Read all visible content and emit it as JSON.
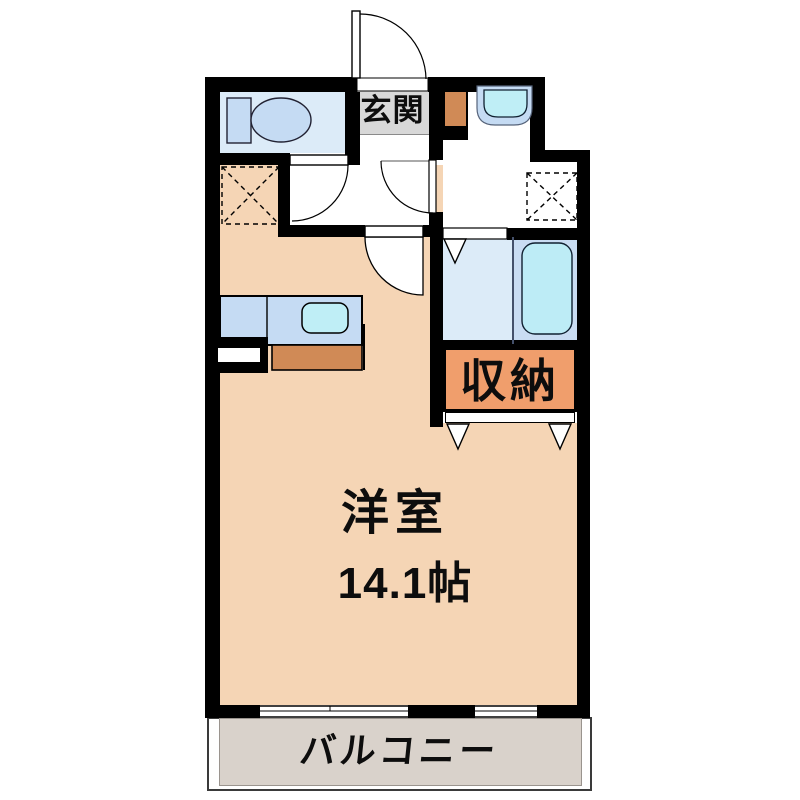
{
  "floorplan": {
    "type": "japanese-apartment-floor-plan",
    "labels": {
      "entrance": "玄関",
      "storage": "収納",
      "room_name": "洋室",
      "room_size": "14.1帖",
      "balcony": "バルコニー"
    },
    "rooms": [
      {
        "name": "entrance-hall",
        "label": "玄関"
      },
      {
        "name": "toilet-room",
        "label": ""
      },
      {
        "name": "washroom",
        "label": ""
      },
      {
        "name": "bathroom",
        "label": ""
      },
      {
        "name": "storage-closet",
        "label": "収納"
      },
      {
        "name": "western-room",
        "label": "洋室",
        "size": "14.1帖"
      },
      {
        "name": "balcony",
        "label": "バルコニー"
      }
    ],
    "icons": [
      "toilet-icon",
      "washbasin-icon",
      "bathtub-icon",
      "kitchen-counter-icon",
      "kitchen-sink-icon",
      "refrigerator-space-icon",
      "washing-machine-space-icon",
      "entrance-door-swing-icon",
      "toilet-door-swing-icon",
      "washroom-door-swing-icon",
      "room-door-swing-icon",
      "folding-door-triangle-icon",
      "sliding-window-icon"
    ],
    "colors": {
      "wall": "#000000",
      "main_room_floor": "#f5d5b5",
      "balcony_floor": "#d9d2cb",
      "wet_area_floor": "#dcebf8",
      "bath_zone_floor": "#c9dcf2",
      "fixture_blue": "#c5dbf3",
      "sink_cyan": "#bfeef6",
      "bathtub_cyan": "#bdecf6",
      "entrance_gray": "#d8d8d8",
      "cabinet_orange": "#d08a56",
      "storage_orange": "#f09e6c"
    }
  }
}
